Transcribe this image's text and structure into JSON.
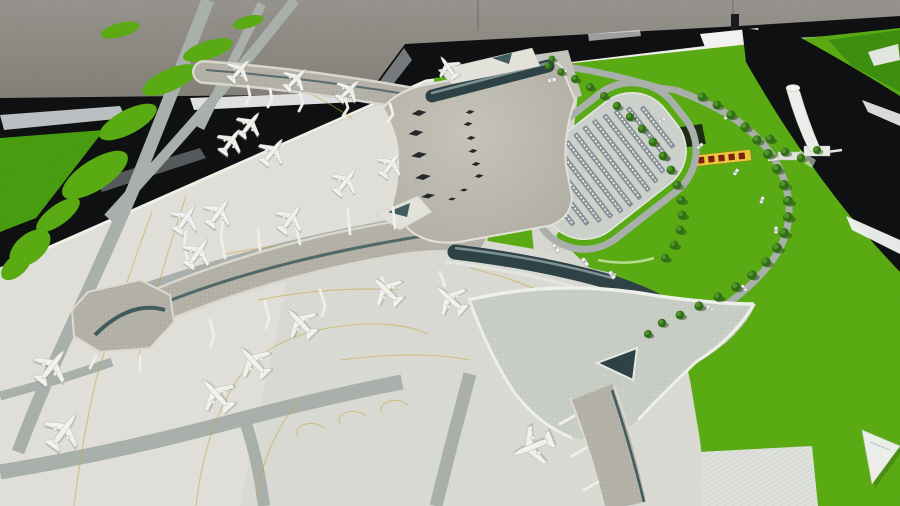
{
  "palette": {
    "wall1": "#95928c",
    "wall2": "#7d7a72",
    "frameBlack": "#0c0e10",
    "frameBlack2": "#17191c",
    "felt": "#58aa11",
    "feltDark": "#3c8d0e",
    "feltShade": "#469c0d",
    "base": "#e0dfd8",
    "apron2": "#d9dad3",
    "corridor": "#d6d7d0",
    "roof1": "#c6c3b9",
    "roof2": "#aeaba1",
    "roofEdge": "#e3e1d9",
    "pier": "#b5b2a8",
    "pierEdge": "#dcdad2",
    "pierUnder": "#d8d6ce",
    "teal": "#3d5a5c",
    "tealDark": "#2c4145",
    "road": "#a9b0ab",
    "roadLight": "#c6c9c2",
    "parkDeck": "#cdd1cb",
    "parkRow": "#879096",
    "tree1": "#2f6d15",
    "tree2": "#4f9426",
    "treeShadow": "#1c3f0b",
    "median": "#b8dc8f",
    "guide": "#c9a340",
    "plane": "#f2f3ef",
    "planeStroke": "#c3c5bd",
    "planeShadow": "#8a8d86",
    "sign": "#ecc83c",
    "signText": "#7c1d0e",
    "white": "#f4f5f1",
    "hatch": "#dfe2dc",
    "pit": "#16200f"
  },
  "scene": {
    "planes": [
      [
        240,
        70,
        42,
        0.8
      ],
      [
        296,
        79,
        44,
        0.8
      ],
      [
        349,
        90,
        46,
        0.8
      ],
      [
        448,
        67,
        -35,
        0.75
      ],
      [
        250,
        124,
        38,
        0.85
      ],
      [
        231,
        141,
        36,
        0.85
      ],
      [
        273,
        151,
        38,
        0.9
      ],
      [
        186,
        218,
        34,
        0.95
      ],
      [
        219,
        212,
        36,
        0.95
      ],
      [
        198,
        252,
        35,
        1.0
      ],
      [
        291,
        218,
        36,
        0.95
      ],
      [
        346,
        181,
        38,
        0.9
      ],
      [
        391,
        164,
        36,
        0.85
      ],
      [
        300,
        322,
        -44,
        1.05
      ],
      [
        386,
        290,
        -46,
        1.05
      ],
      [
        450,
        299,
        -48,
        1.05
      ],
      [
        253,
        361,
        -43,
        1.1
      ],
      [
        216,
        394,
        -42,
        1.15
      ],
      [
        52,
        366,
        38,
        1.15
      ],
      [
        64,
        430,
        36,
        1.2
      ],
      [
        532,
        447,
        -112,
        1.25
      ]
    ],
    "trees": [
      [
        548,
        66,
        0.9
      ],
      [
        561,
        72,
        0.95
      ],
      [
        575,
        79,
        1
      ],
      [
        590,
        87,
        1
      ],
      [
        604,
        96,
        1
      ],
      [
        617,
        106,
        1.05
      ],
      [
        630,
        117,
        1.05
      ],
      [
        642,
        129,
        1.05
      ],
      [
        653,
        142,
        1.1
      ],
      [
        663,
        156,
        1.1
      ],
      [
        671,
        170,
        1.1
      ],
      [
        677,
        185,
        1.1
      ],
      [
        681,
        200,
        1.1
      ],
      [
        682,
        215,
        1.1
      ],
      [
        680,
        230,
        1.1
      ],
      [
        674,
        245,
        1.1
      ],
      [
        665,
        258,
        1.05
      ],
      [
        702,
        97,
        1.1
      ],
      [
        717,
        105,
        1.1
      ],
      [
        731,
        115,
        1.15
      ],
      [
        745,
        127,
        1.2
      ],
      [
        757,
        140,
        1.2
      ],
      [
        768,
        154,
        1.25
      ],
      [
        777,
        169,
        1.25
      ],
      [
        784,
        185,
        1.25
      ],
      [
        788,
        201,
        1.25
      ],
      [
        788,
        217,
        1.25
      ],
      [
        784,
        233,
        1.25
      ],
      [
        777,
        248,
        1.25
      ],
      [
        766,
        262,
        1.2
      ],
      [
        752,
        275,
        1.2
      ],
      [
        736,
        287,
        1.2
      ],
      [
        718,
        297,
        1.15
      ],
      [
        699,
        306,
        1.15
      ],
      [
        680,
        315,
        1.1
      ],
      [
        662,
        323,
        1.05
      ],
      [
        648,
        334,
        1.0
      ],
      [
        770,
        139,
        1.1
      ],
      [
        785,
        152,
        1.1
      ],
      [
        801,
        158,
        1.05
      ],
      [
        817,
        150,
        1.0
      ],
      [
        552,
        59,
        0.85
      ]
    ],
    "cars": [
      [
        662,
        120,
        -28,
        1
      ],
      [
        700,
        146,
        -40,
        1
      ],
      [
        736,
        172,
        -55,
        1
      ],
      [
        762,
        200,
        -70,
        1
      ],
      [
        776,
        230,
        -88,
        1
      ],
      [
        768,
        262,
        -108,
        1
      ],
      [
        744,
        288,
        -128,
        1
      ],
      [
        710,
        308,
        -148,
        1
      ],
      [
        727,
        117,
        -35,
        0.9
      ],
      [
        757,
        142,
        -52,
        0.9
      ],
      [
        552,
        80,
        -15,
        1.2
      ],
      [
        563,
        72,
        -15,
        1.1
      ],
      [
        556,
        248,
        52,
        1.3
      ],
      [
        585,
        262,
        54,
        1.3
      ],
      [
        612,
        275,
        56,
        1.2
      ]
    ],
    "skylights": [
      [
        419,
        113,
        15,
        6
      ],
      [
        416,
        133,
        15,
        6
      ],
      [
        419,
        155,
        16,
        6
      ],
      [
        423,
        177,
        16,
        6
      ],
      [
        428,
        196,
        14,
        5
      ],
      [
        470,
        112,
        9,
        4
      ],
      [
        468,
        124,
        9,
        4
      ],
      [
        471,
        138,
        9,
        4
      ],
      [
        473,
        151,
        9,
        4
      ],
      [
        476,
        164,
        9,
        4
      ],
      [
        479,
        176,
        9,
        4
      ],
      [
        464,
        190,
        8,
        3
      ],
      [
        452,
        199,
        8,
        3
      ]
    ],
    "lawn_patches": [
      [
        208,
        50,
        26,
        9,
        -18
      ],
      [
        170,
        80,
        30,
        11,
        -24
      ],
      [
        128,
        122,
        32,
        12,
        -28
      ],
      [
        95,
        175,
        38,
        15,
        -33
      ],
      [
        58,
        215,
        26,
        10,
        -36
      ],
      [
        30,
        248,
        24,
        14,
        -40
      ],
      [
        120,
        30,
        20,
        7,
        -15
      ],
      [
        248,
        22,
        16,
        6,
        -15
      ],
      [
        16,
        266,
        18,
        10,
        -42
      ]
    ],
    "parking": {
      "cx": 608,
      "cy": 166,
      "rot": 52,
      "rows": 12,
      "row_gap": 11.5,
      "ry": 76,
      "rx_max": 46
    },
    "sign": {
      "glyph_count": 5
    }
  }
}
